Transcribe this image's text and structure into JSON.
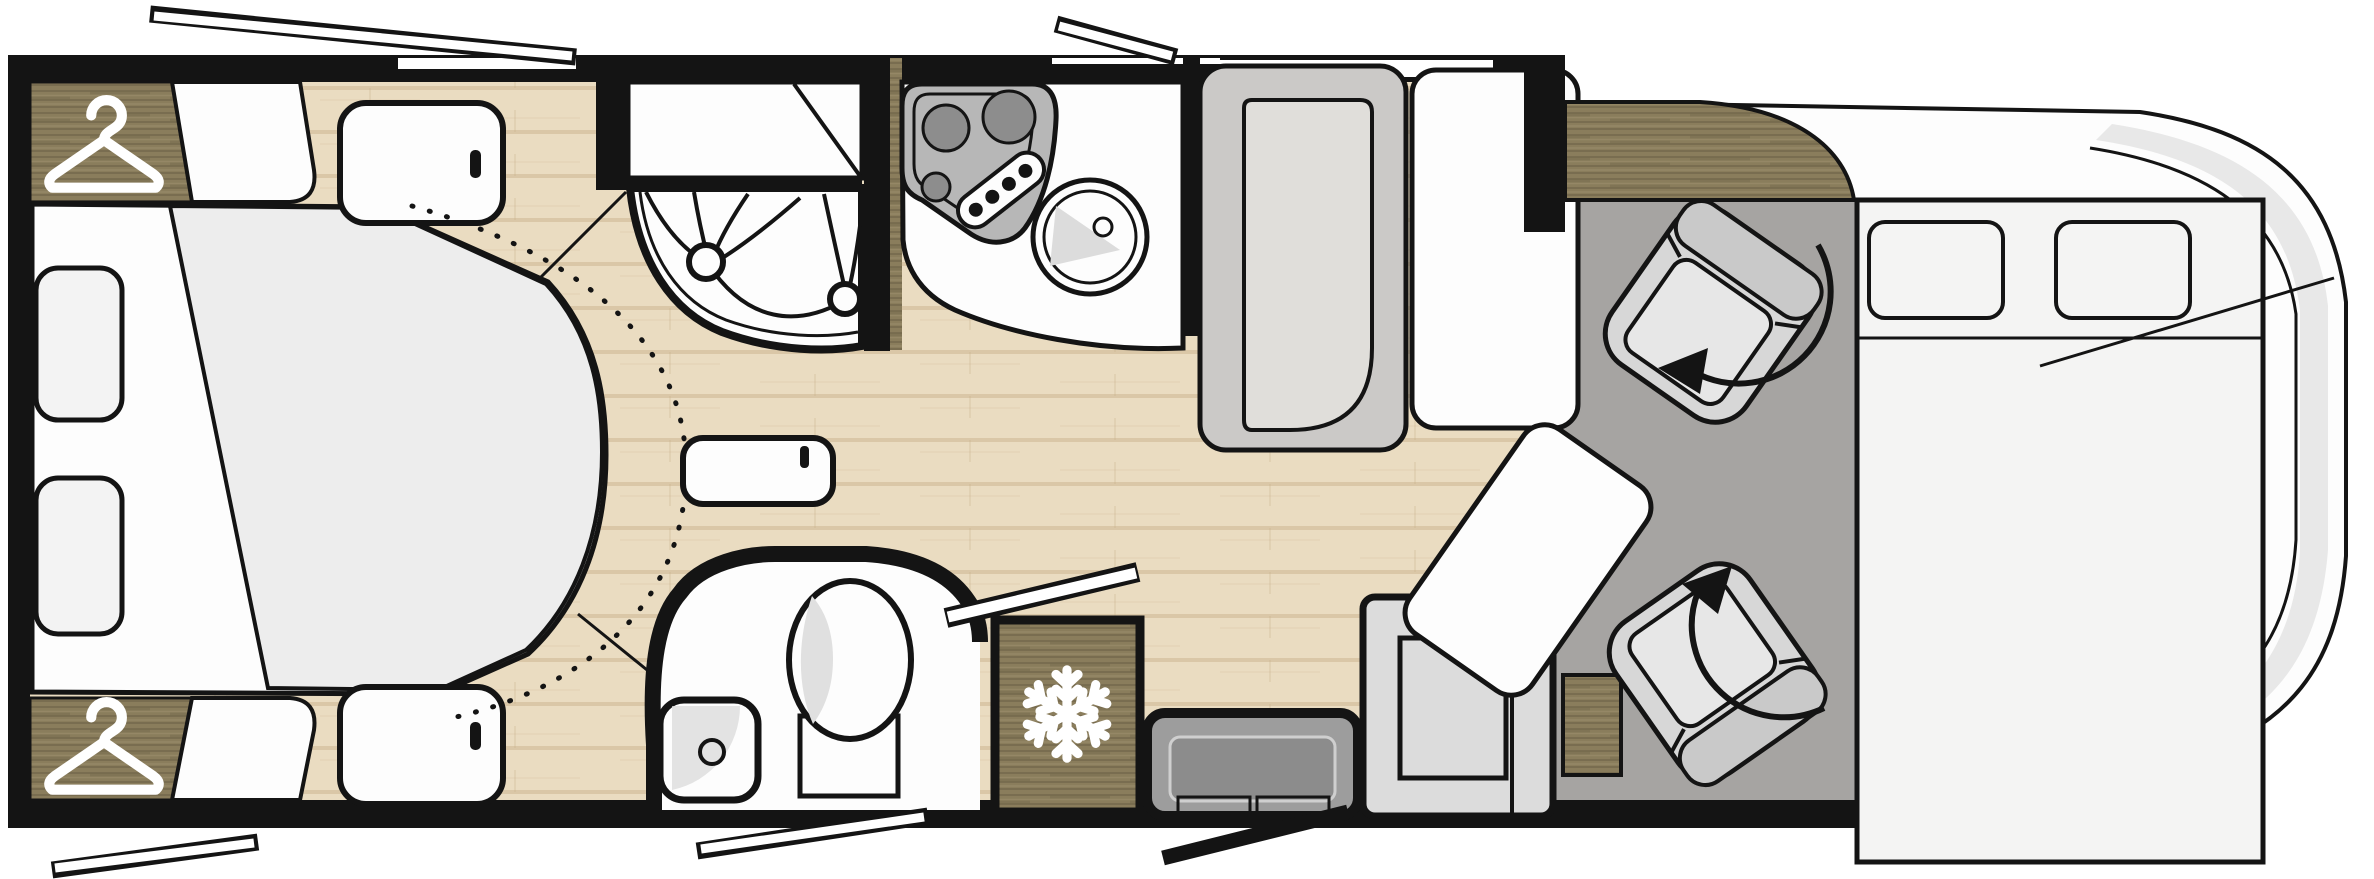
{
  "diagram": {
    "type": "motorhome-floorplan",
    "view": "top-down",
    "front_of_vehicle": "right",
    "rear_of_vehicle": "left"
  },
  "colors": {
    "line": "#141414",
    "white": "#fdfdfd",
    "floor-base": "#eadcc1",
    "floor-line": "#c7ad86",
    "wood-base": "#8a7d5c",
    "wood-dark": "#6d6247",
    "wood-light": "#a09170",
    "duvet": "#ededed",
    "pillow": "#f3f3f3",
    "cab-floor": "#a6a4a2",
    "bench-back": "#cbc9c7",
    "bench-seat": "#e0deda",
    "seat-gray": "#d7d7d7",
    "seat-back": "#c9c9c9",
    "seat-cushion": "#e7e7e7",
    "steel": "#b7b7b7",
    "burner": "#8d8d8d",
    "body-band": "#e8e8e8",
    "bed-panel": "#f4f4f3",
    "cabinet": "#dcdcdc",
    "step": "#9d9d9d",
    "step-inner": "#8c8c8c",
    "shading": "#dadada"
  },
  "icons": [
    {
      "name": "hanger-icon",
      "meaning": "wardrobe",
      "count": 2
    },
    {
      "name": "snowflake-icon",
      "meaning": "refrigerator",
      "count": 1
    },
    {
      "name": "swivel-arrow-icon",
      "meaning": "rotating cab seat",
      "count": 2
    }
  ],
  "areas": {
    "bedroom": {
      "position": "rear (left end)",
      "features": [
        "island bed",
        "duvet",
        "2 pillows",
        "wardrobe with hanger icon (top)",
        "wardrobe with hanger icon (bottom)",
        "2 bedside cabinets with handles",
        "dotted walk-around arc"
      ]
    },
    "shower_room": {
      "position": "mid, top side",
      "features": [
        "quarter-circle shower tray",
        "bi-fold curved door with 2 knobs",
        "storage cabinet with diagonal front"
      ]
    },
    "kitchen": {
      "position": "mid, top side",
      "features": [
        "3-burner hob",
        "control panel with 4 knobs",
        "round sink with tap"
      ]
    },
    "bathroom": {
      "position": "mid, bottom side",
      "features": [
        "toilet",
        "corner washbasin with drain",
        "curved partition wall",
        "open door leaf"
      ]
    },
    "refrigerator": {
      "position": "bottom, beside bathroom",
      "features": [
        "snowflake icon"
      ]
    },
    "entrance": {
      "position": "bottom side",
      "features": [
        "entry step",
        "open entry door"
      ]
    },
    "dinette": {
      "position": "mid-front",
      "features": [
        "bench with backrest",
        "side table",
        "swivel table extension"
      ]
    },
    "cab": {
      "position": "front (right end)",
      "features": [
        "driver swivel seat with rotation arrow",
        "passenger swivel seat with rotation arrow",
        "drop-down bed with 2 pillows",
        "dashboard counter (wood)"
      ]
    },
    "windows": {
      "open_window_flaps": 4,
      "wall_windows": [
        "rear bedroom window (top wall)",
        "dinette window (top wall)"
      ]
    }
  }
}
